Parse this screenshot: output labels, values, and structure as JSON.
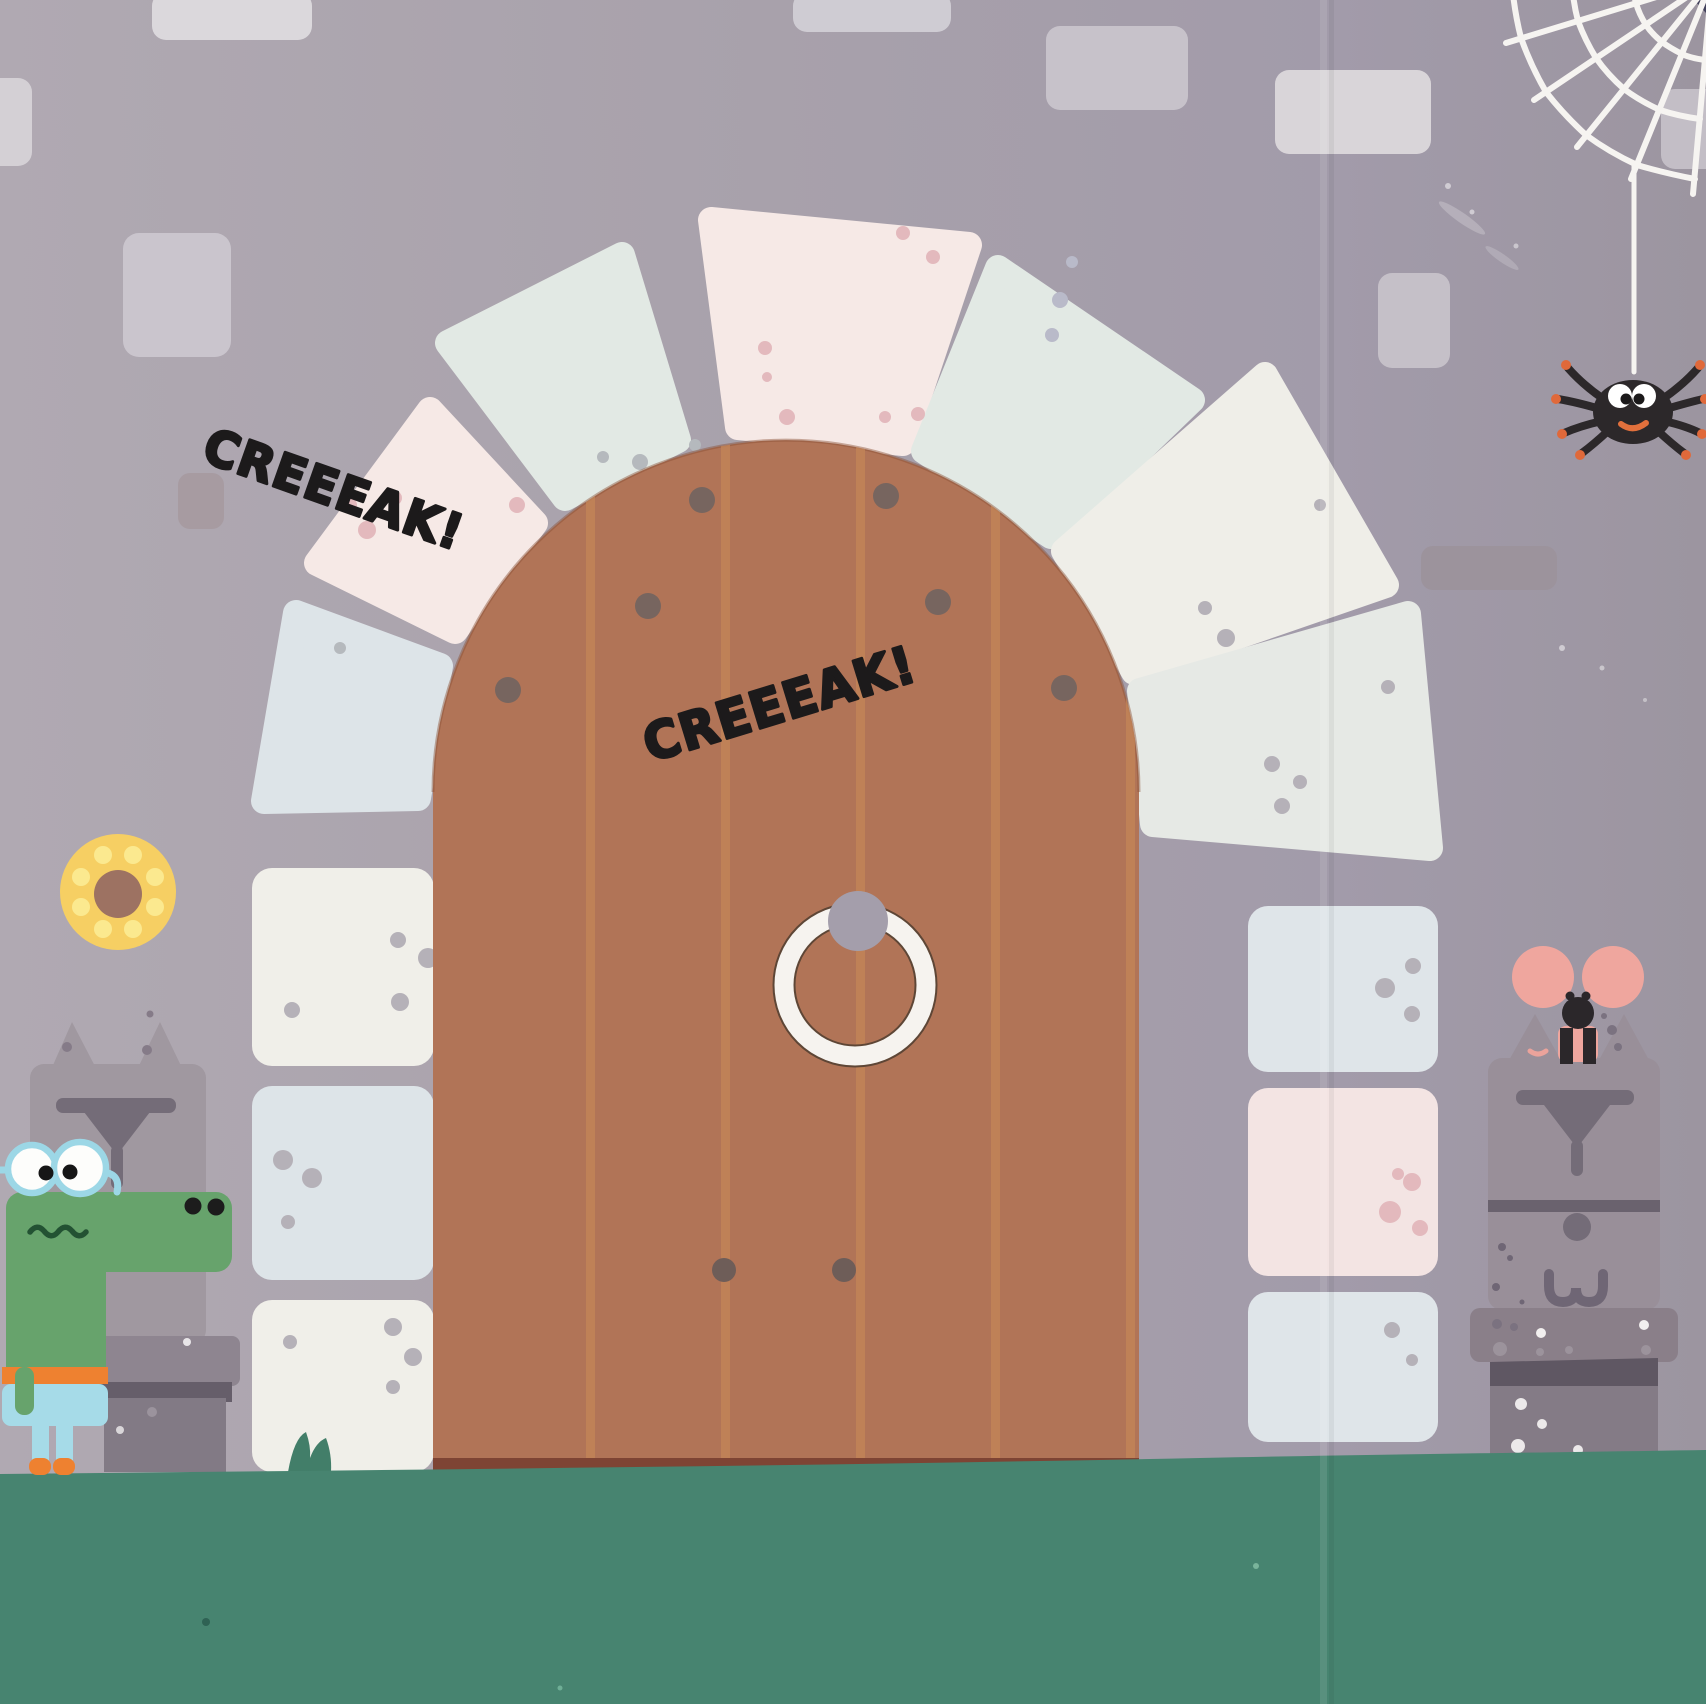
{
  "scene": {
    "sound_effects": {
      "first": "CREEEAK!",
      "second": "CREEEAK!"
    }
  },
  "palette": {
    "wall": "#a8a1ab",
    "wall_left": "#b0a9b2",
    "wall_right": "#9c95a0",
    "brick_light": "#d6d3d8",
    "stone_white": "#efeee8",
    "stone_blue": "#dde4e8",
    "stone_green": "#e2e9e4",
    "stone_pink": "#f6e9e6",
    "door_wood": "#b17457",
    "door_stripe": "#c38457",
    "door_trim": "#7e4434",
    "door_nail": "#77655f",
    "handle_ring": "#f6f3ef",
    "handle_knob": "#a49eab",
    "ground": "#478470",
    "grass": "#427e69",
    "croc_green": "#67a36c",
    "croc_pants": "#a6dbe8",
    "croc_belt": "#ee8130",
    "glasses_blue": "#9cd7e6",
    "donut": "#f6cf63",
    "donut_hole": "#9d7262",
    "donut_sprinkle": "#fbe98f",
    "statue_gray": "#a098a0",
    "statue_gray_right": "#998f99",
    "statue_face": "#746c78",
    "mouse_pink": "#efa69e",
    "spider_black": "#2c282a",
    "leg_tip_orange": "#e0693a",
    "web_white": "#f6f4f1",
    "text_black": "#1c1a1b"
  }
}
